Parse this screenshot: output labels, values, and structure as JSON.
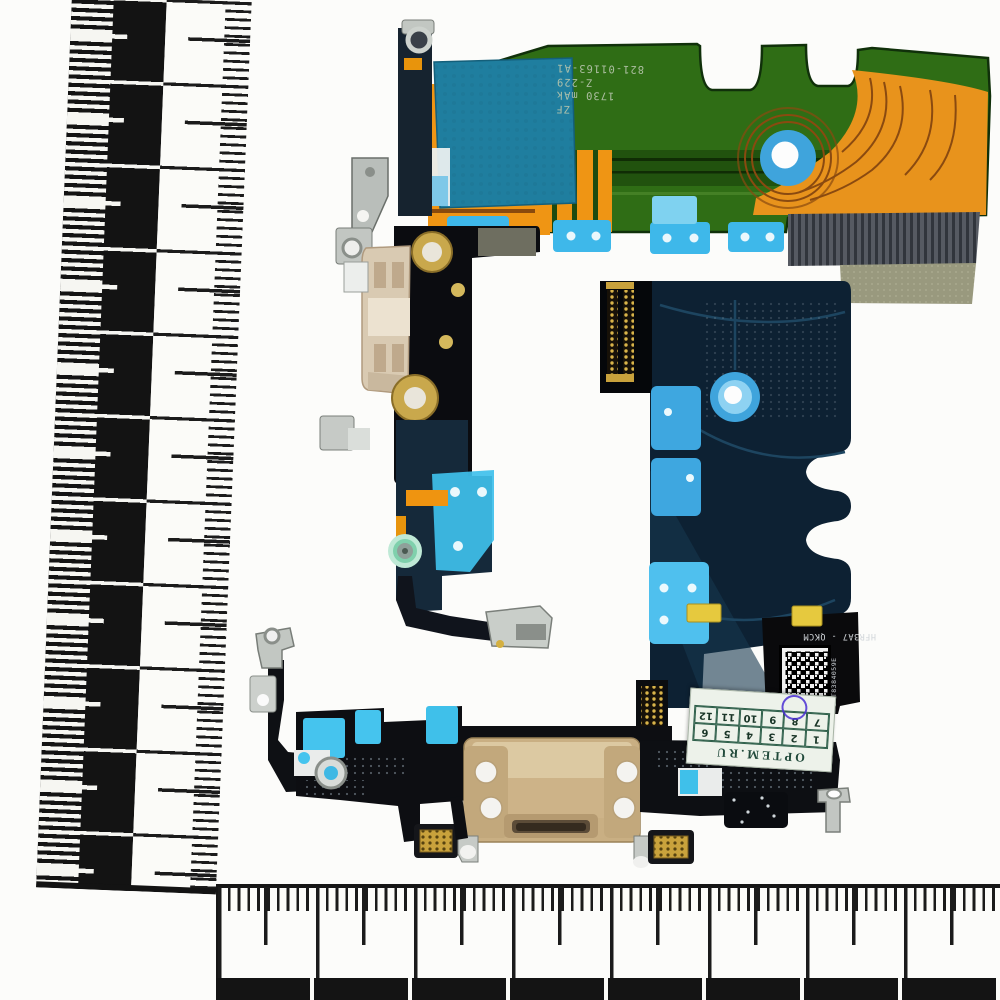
{
  "scene": {
    "description_type": "photo",
    "background": "#fcfcfa"
  },
  "pcb_markings": {
    "line1": "821-01163-A1",
    "line2": "Z-229",
    "line3": "1730 mAk",
    "line4": "ZF"
  },
  "flex_markings": {
    "part_code": "HFR3A7 - QKCM",
    "vertical_serial": "DTT8384059E"
  },
  "label": {
    "brand": "OPTEM.RU",
    "row1": [
      "1",
      "2",
      "3",
      "4",
      "5",
      "6"
    ],
    "row2": [
      "7",
      "8",
      "9",
      "10",
      "11",
      "12"
    ],
    "circled_number": "8"
  },
  "palette": {
    "green_pcb": "#2f6d15",
    "green_dark": "#1d4a0c",
    "orange_flex": "#ef9514",
    "orange_right": "#e8931c",
    "teal_patch": "#1f7e9f",
    "adhesive_blue": "#3fc0ec",
    "navy_flex": "#0d2133",
    "circle_blue": "#3fa4dc",
    "gold_housing": "#c9af83",
    "gold_pad": "#e6c93e",
    "beige_connector": "#d9cab2",
    "metal_silver": "#c6cac6",
    "khaki_stiffener": "#99997e",
    "ribbed_gray": "#565a62",
    "label_green": "#2e5f4a",
    "pen_purple": "#4a2fd4",
    "ruler_black": "#131313"
  }
}
